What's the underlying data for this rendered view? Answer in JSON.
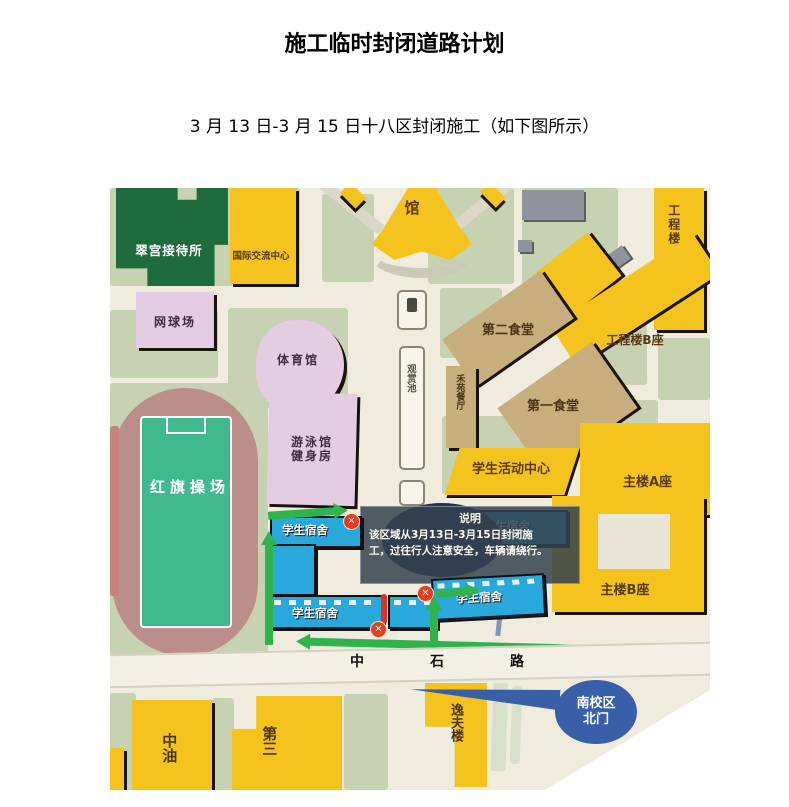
{
  "page": {
    "title": "施工临时封闭道路计划",
    "subtitle": "3 月 13 日-3 月 15 日十八区封闭施工（如下图所示）"
  },
  "map": {
    "labels": {
      "cuigong_reception": "翠宫接待所",
      "intl_exchange_center": "国际交流中心",
      "tennis_court": "网球场",
      "gymnasium": "体育馆",
      "library_hall": "馆",
      "pool_line1": "游泳馆",
      "pool_line2": "健身房",
      "red_flag_playground": "红旗操场",
      "ornamental_pond": "观赏池",
      "second_canteen": "第二食堂",
      "heyuan_restaurant": "禾苑餐厅",
      "first_canteen": "第一食堂",
      "student_activity_center": "学生活动中心",
      "engineering_a": "工程楼A座",
      "engineering_b": "工程楼B座",
      "main_a": "主楼A座",
      "main_b": "主楼B座",
      "student_dorm": "学生宿舍",
      "zhongyou": "中油",
      "third_building": "第三",
      "yifu_building": "逸夫楼",
      "zhongshi_road": "中石路",
      "gate_line1": "南校区",
      "gate_line2": "北门"
    },
    "callout": {
      "title": "说明",
      "line1": "该区域从3月13日-3月15日封闭施",
      "line2": "工，过往行人注意安全，车辆请绕行。"
    },
    "closure_mark": "✕",
    "colors": {
      "building_yellow": "#f4c31d",
      "building_tan": "#c8ae7c",
      "building_pink": "#e4cce2",
      "building_blue": "#29a8dc",
      "building_dark_green": "#1e6b3d",
      "lawn_green": "#c7d2b2",
      "ground_cream": "#efebdd",
      "closure_red": "#e83c1a",
      "detour_arrow_green": "#2eb34d",
      "gate_blue": "#3a5fa9",
      "track_red": "#bc8e8a",
      "field_green": "#40b98c"
    }
  }
}
